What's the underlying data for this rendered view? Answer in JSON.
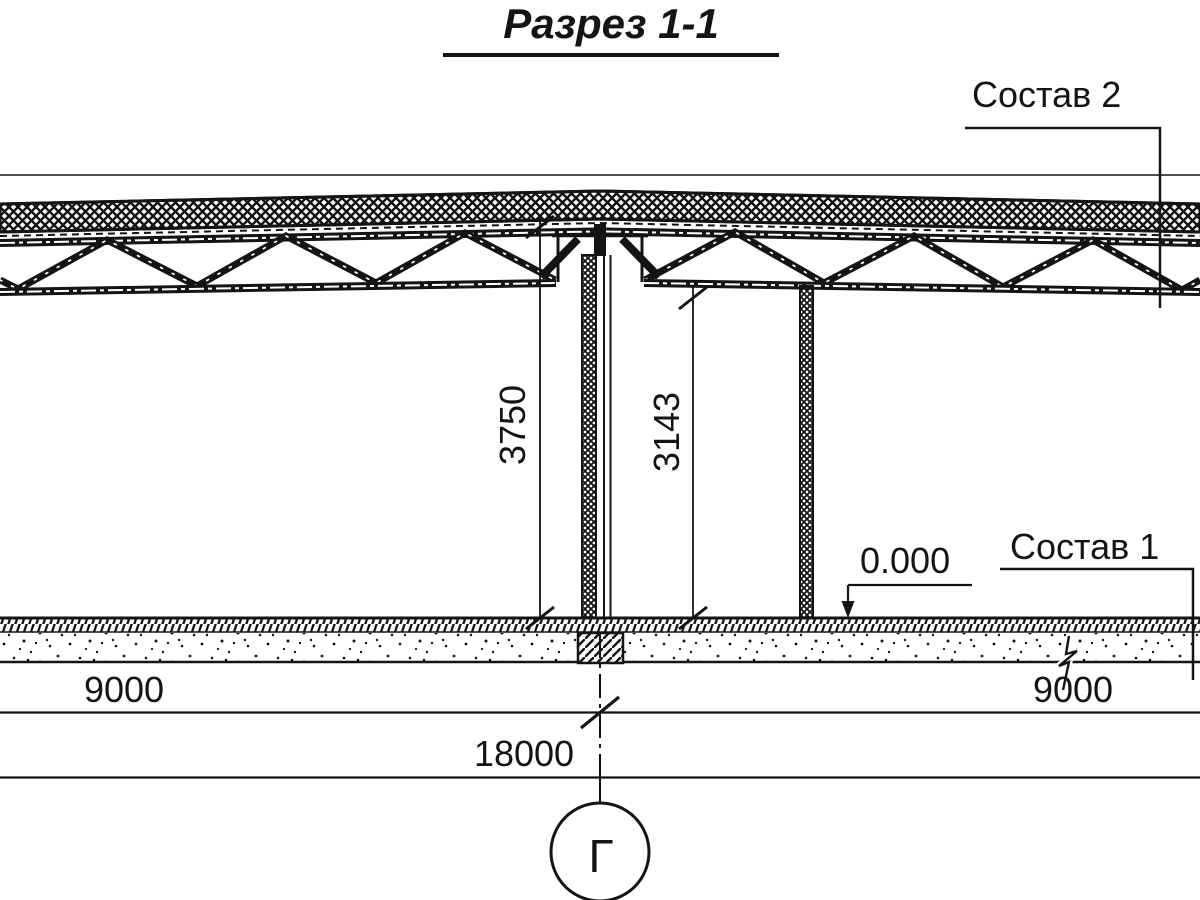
{
  "title": "Разрез 1-1",
  "labels": {
    "roof_composition": "Состав 2",
    "floor_composition": "Состав 1",
    "elevation_mark": "0.000",
    "grid_axis": "Г"
  },
  "dimensions": {
    "height_floor_to_roof": "3750",
    "height_floor_to_truss": "3143",
    "span_left": "9000",
    "span_right": "9000",
    "span_total": "18000"
  },
  "colors": {
    "ink": "#141414",
    "background": "#ffffff"
  }
}
